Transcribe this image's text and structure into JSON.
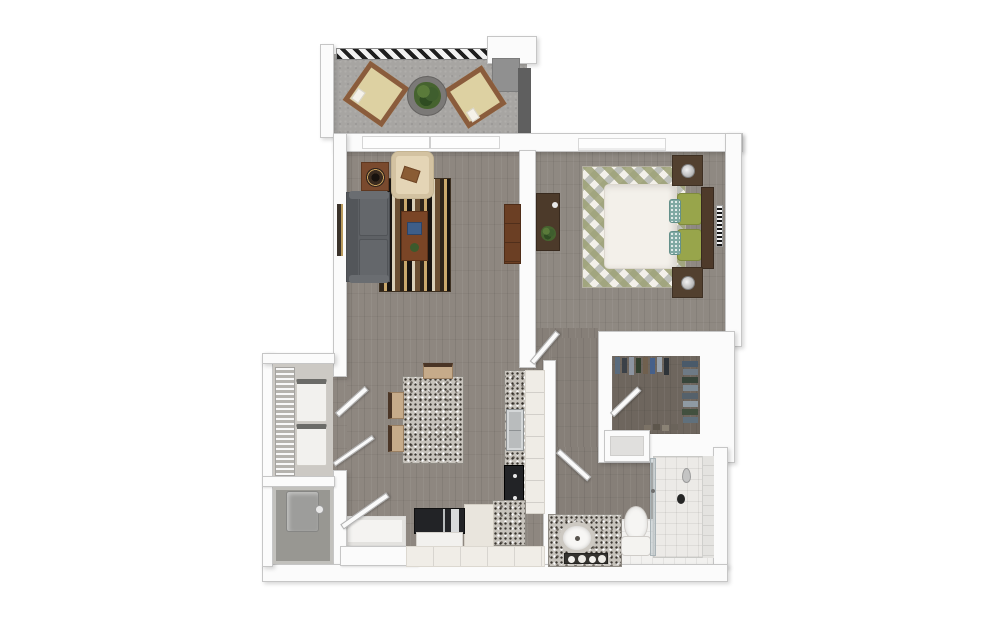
{
  "meta": {
    "description": "3D top-down rendered floor plan of a one-bedroom, one-bath apartment with balcony, open living/dining/kitchen area, walk-in closet, stacked laundry closet and utility closet",
    "view": "orthographic top-down 3D render",
    "visible_text": "none (only a tiny illegible barcode-style label on the bedroom wall)"
  },
  "palette": {
    "page_bg": "#ffffff",
    "wall": "#fbfbfb",
    "wall_edge": "#c6c6c6",
    "wood_floor": "#8e8780",
    "bedroom_floor": "#8f8982",
    "corridor_floor": "#867f78",
    "closet_floor": "#6e665e",
    "balcony_floor": "#a7a5a2",
    "tile_floor": "#f2f1ef",
    "granite": "#c7c3bc",
    "sofa_gray": "#5e6165",
    "armchair_cream": "#e4d5b6",
    "pillow_green": "#98a54b",
    "pillow_teal": "#7fa8a2",
    "bed_duvet": "#f3f0ea",
    "dark_wood": "#4e3a2a",
    "mid_wood": "#7a4a2e",
    "chair_tan": "#c6ab8a",
    "chair_frame": "#4a3526",
    "appliance_black": "#222326",
    "stainless": "#b9bcbd",
    "white_goods": "#f2f1ee",
    "water_heater_gray": "#9d9d9b",
    "plant_green": "#46632f",
    "balcony_cushion": "#ddd1a2",
    "balcony_frame": "#8a5c3c",
    "railing_dark": "#1f1f1f",
    "gray_column": "#909090",
    "dark_edge": "#5f5f5f"
  },
  "scene": {
    "type": "3d-floor-plan",
    "unit": "one-bedroom / one-bath apartment",
    "rooms": [
      {
        "name": "balcony",
        "furniture": [
          "lounge-chair",
          "lounge-chair",
          "round-planter-table",
          "striped-railing"
        ]
      },
      {
        "name": "living-room",
        "furniture": [
          "gray-sofa",
          "cream-armchair",
          "striped-area-rug",
          "coffee-table-with-book",
          "speaker-side-table",
          "media-console",
          "wall-art",
          "sliding-glass-door"
        ]
      },
      {
        "name": "bedroom",
        "furniture": [
          "bed-with-white-duvet",
          "green-accent-pillows",
          "headboard",
          "nightstand-with-lamp",
          "nightstand-with-lamp",
          "diamond-pattern-rug",
          "desk-with-plant",
          "window",
          "barcode-wall-label"
        ]
      },
      {
        "name": "walk-in-closet",
        "furniture": [
          "hanging-clothes-top-rail",
          "hanging-clothes-side-rail",
          "shoe-row",
          "angled-door"
        ]
      },
      {
        "name": "bathroom",
        "furniture": [
          "granite-vanity",
          "oval-sink",
          "candle-tray",
          "toilet",
          "walk-in-shower",
          "glass-shower-door",
          "linen-niche",
          "angled-door"
        ]
      },
      {
        "name": "kitchen",
        "furniture": [
          "granite-island",
          "dining-chair",
          "dining-chair",
          "dining-chair",
          "counter-run",
          "stainless-sink",
          "black-cooktop",
          "refrigerator",
          "base-cabinets"
        ]
      },
      {
        "name": "laundry-closet",
        "furniture": [
          "wire-shelving",
          "stacked-washer",
          "stacked-dryer",
          "double-doors"
        ]
      },
      {
        "name": "utility-closet",
        "furniture": [
          "water-heater"
        ]
      },
      {
        "name": "entry",
        "furniture": [
          "entry-door",
          "tile-mat"
        ]
      }
    ]
  }
}
